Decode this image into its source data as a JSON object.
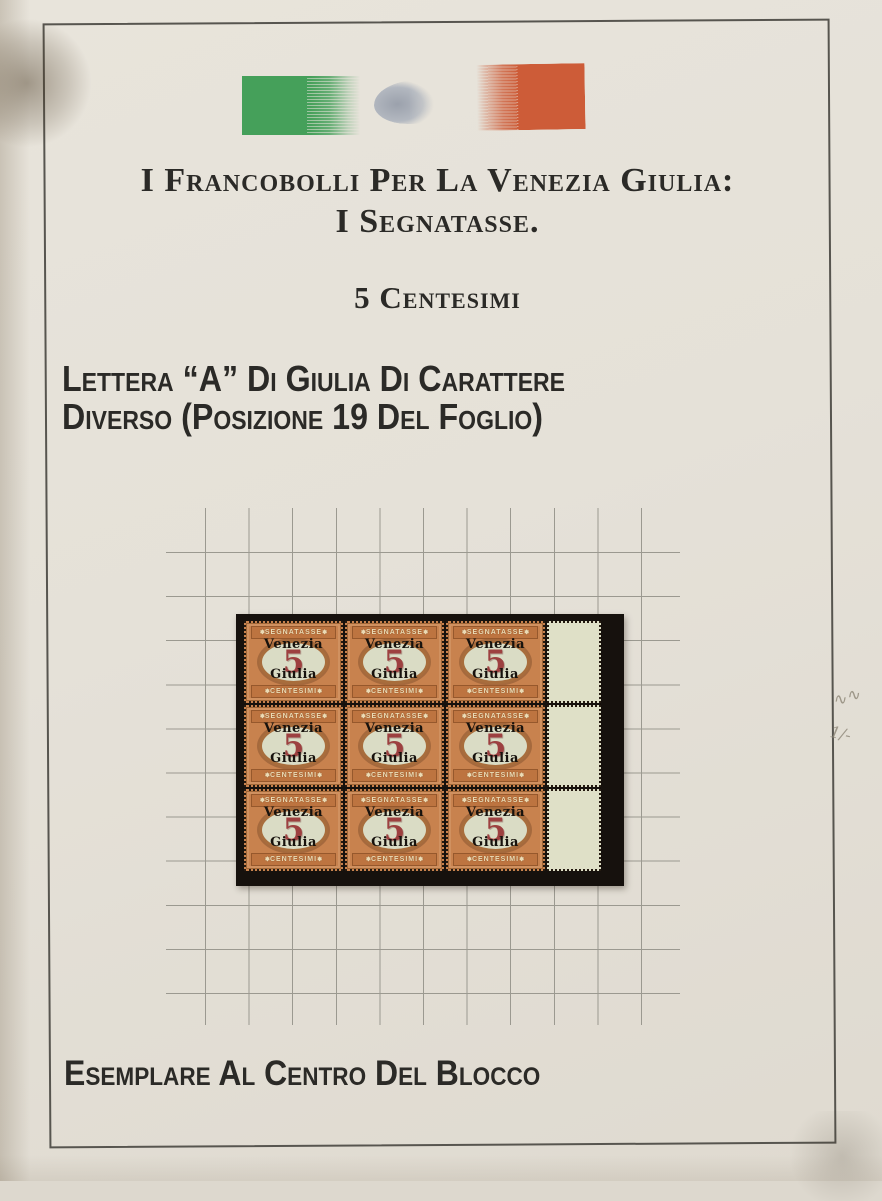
{
  "header": {
    "title_line1": "I Francobolli Per La Venezia Giulia:",
    "title_line2": "I Segnatasse.",
    "denomination": "5 Centesimi"
  },
  "description": {
    "line1": "Lettera “A” Di Giulia Di Carattere",
    "line2": "Diverso (Posizione 19 Del Foglio)"
  },
  "caption": {
    "text": "Esemplare Al Centro Del Blocco"
  },
  "stamp": {
    "top_label": "SEGNATASSE",
    "overprint_line1": "Venezia",
    "overprint_line2": "Giulia",
    "value": "5",
    "bottom_label": "CENTESIMI",
    "ornament": "✽"
  },
  "pencil_marks": {
    "mark1": "∿∿",
    "mark2": "1/-"
  },
  "colors": {
    "flag_green": "#45a05a",
    "flag_red": "#cd5c38",
    "smudge": "#9ba1ac",
    "ink": "#2b2a27",
    "frame_line": "#57554f",
    "grid_line": "#9b9990",
    "mount": "#16110d",
    "stamp_orange": "#c8824e",
    "band_bg": "#bd7440",
    "band_text": "#ecdcb6",
    "oval_bg": "#dadcc5",
    "value_red": "#9d4040",
    "overprint": "#17120d",
    "selvage": "#dfe0c7",
    "pencil": "#8d8677"
  }
}
